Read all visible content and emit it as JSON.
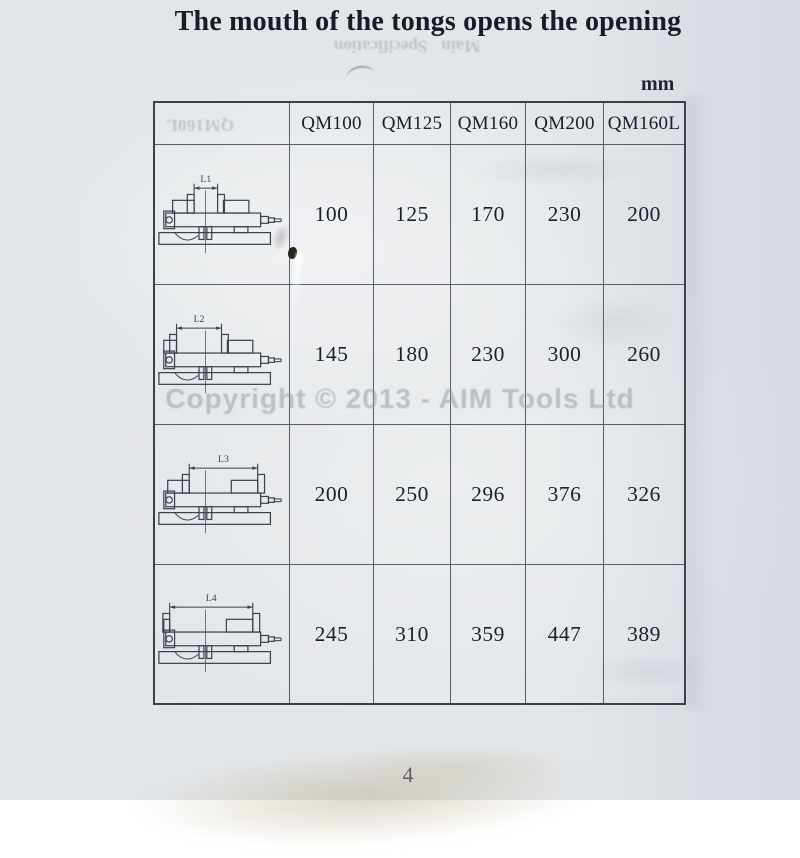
{
  "page": {
    "title": "The mouth of the tongs opens the opening",
    "unit_label": "mm",
    "page_number": "4",
    "watermark": "Copyright © 2013 - AIM Tools Ltd",
    "bleed_through": {
      "heading": "Main Specification",
      "header_cell": "QM160L"
    }
  },
  "table": {
    "columns": [
      "QM100",
      "QM125",
      "QM160",
      "QM200",
      "QM160L"
    ],
    "rows": [
      {
        "dimension_label": "L1",
        "jaw_span": {
          "x1": 40,
          "x2": 64
        },
        "values": [
          "100",
          "125",
          "170",
          "230",
          "200"
        ]
      },
      {
        "dimension_label": "L2",
        "jaw_span": {
          "x1": 22,
          "x2": 68
        },
        "values": [
          "145",
          "180",
          "230",
          "300",
          "260"
        ]
      },
      {
        "dimension_label": "L3",
        "jaw_span": {
          "x1": 35,
          "x2": 105
        },
        "values": [
          "200",
          "250",
          "296",
          "376",
          "326"
        ]
      },
      {
        "dimension_label": "L4",
        "jaw_span": {
          "x1": 15,
          "x2": 100
        },
        "values": [
          "245",
          "310",
          "359",
          "447",
          "389"
        ]
      }
    ]
  },
  "colors": {
    "paper": "#e2e5e9",
    "ink": "#20242d",
    "line": "#3a4150",
    "watermark": "#9a9da2"
  }
}
